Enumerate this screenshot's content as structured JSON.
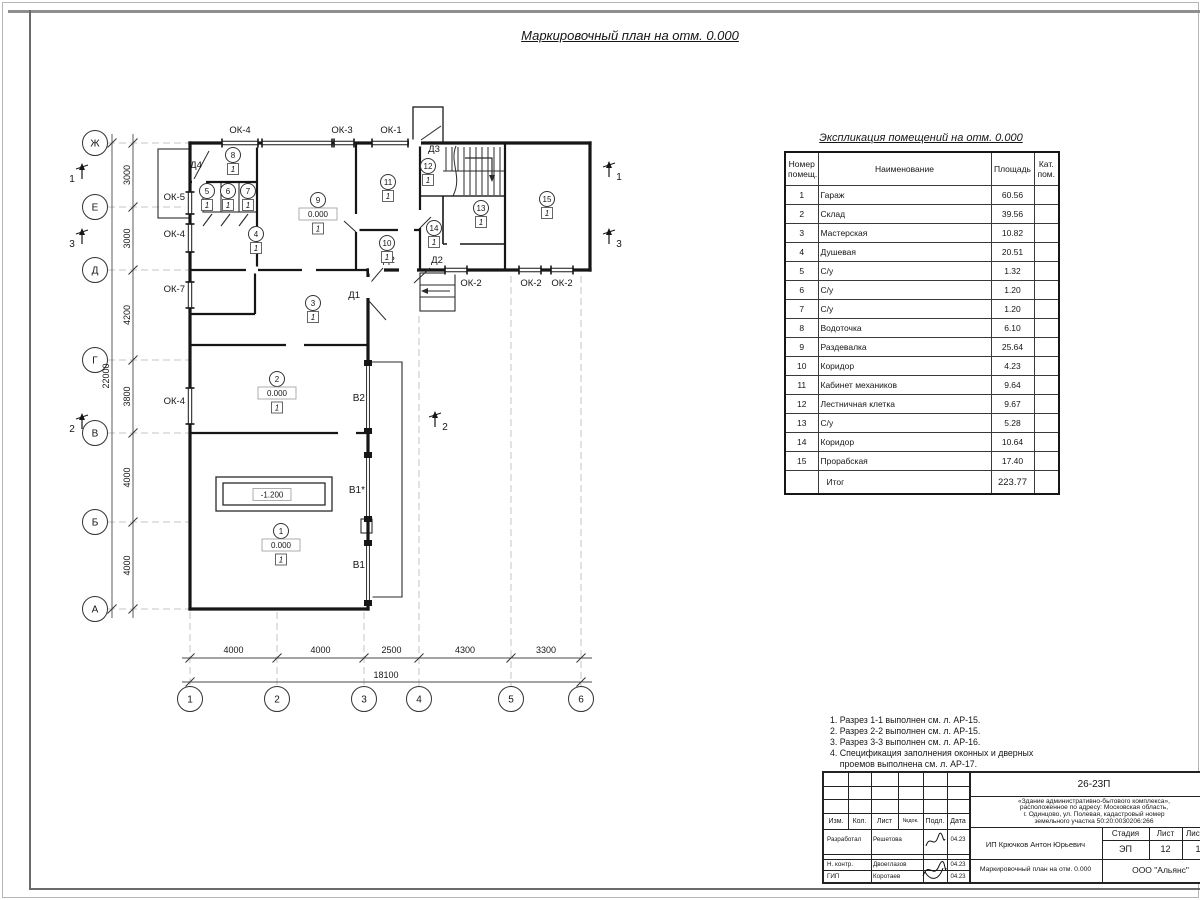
{
  "page": {
    "title": "Маркировочный план на отм. 0.000"
  },
  "table": {
    "title": "Экспликация помещений на отм. 0.000",
    "headers": {
      "num": "Номер помещ.",
      "name": "Наименование",
      "area": "Площадь",
      "cat": "Кат. пом."
    },
    "rows": [
      {
        "num": "1",
        "name": "Гараж",
        "area": "60.56"
      },
      {
        "num": "2",
        "name": "Склад",
        "area": "39.56"
      },
      {
        "num": "3",
        "name": "Мастерская",
        "area": "10.82"
      },
      {
        "num": "4",
        "name": "Душевая",
        "area": "20.51"
      },
      {
        "num": "5",
        "name": "С/у",
        "area": "1.32"
      },
      {
        "num": "6",
        "name": "С/у",
        "area": "1.20"
      },
      {
        "num": "7",
        "name": "С/у",
        "area": "1.20"
      },
      {
        "num": "8",
        "name": "Водоточка",
        "area": "6.10"
      },
      {
        "num": "9",
        "name": "Раздевалка",
        "area": "25.64"
      },
      {
        "num": "10",
        "name": "Коридор",
        "area": "4.23"
      },
      {
        "num": "11",
        "name": "Кабинет механиков",
        "area": "9.64"
      },
      {
        "num": "12",
        "name": "Лестничная клетка",
        "area": "9.67"
      },
      {
        "num": "13",
        "name": "С/у",
        "area": "5.28"
      },
      {
        "num": "14",
        "name": "Коридор",
        "area": "10.64"
      },
      {
        "num": "15",
        "name": "Прорабская",
        "area": "17.40"
      }
    ],
    "total": {
      "label": "Итог",
      "area": "223.77"
    }
  },
  "notes": [
    "1. Разрез 1-1 выполнен см. л. АР-15.",
    "2. Разрез 2-2 выполнен см. л. АР-15.",
    "3. Разрез 3-3 выполнен см. л. АР-16.",
    "4. Спецификация заполнения оконных и дверных",
    "    проемов выполнена см. л. АР-17.",
    "5. Экспликация полов выполнена см. л. АР-17."
  ],
  "stamp": {
    "doc_number": "26-23П",
    "object_lines": [
      "«Здание административно-бытового комплекса»,",
      "расположенное по адресу: Московская область,",
      "г. Одинцово, ул. Полевая, кадастровый номер",
      "земельного участка 50:20:0030206:266"
    ],
    "rev_headers": [
      "Изм.",
      "Кол.",
      "Лист",
      "№док.",
      "Подл.",
      "Дата"
    ],
    "roles": [
      {
        "role": "Разработал",
        "name": "Решетова",
        "date": "04.23"
      },
      {
        "role": "Н. контр.",
        "name": "Двоеглазов",
        "date": "04.23"
      },
      {
        "role": "ГИП",
        "name": "Коротаев",
        "date": "04.23"
      }
    ],
    "client": "ИП Крючков Антон Юрьевич",
    "stage_label": "Стадия",
    "sheet_label": "Лист",
    "sheets_label": "Листов",
    "stage": "ЭП",
    "sheet": "12",
    "sheets": "17",
    "sheet_title": "Маркировочный план на отм. 0.000",
    "company": "ООО \"Альянс\""
  },
  "plan": {
    "axis_rows": [
      {
        "l": "Ж",
        "y": 143
      },
      {
        "l": "Е",
        "y": 207
      },
      {
        "l": "Д",
        "y": 270
      },
      {
        "l": "Г",
        "y": 360
      },
      {
        "l": "В",
        "y": 433
      },
      {
        "l": "Б",
        "y": 522
      },
      {
        "l": "А",
        "y": 609
      }
    ],
    "axis_cols": [
      {
        "l": "1",
        "x": 190
      },
      {
        "l": "2",
        "x": 277
      },
      {
        "l": "3",
        "x": 364
      },
      {
        "l": "4",
        "x": 419
      },
      {
        "l": "5",
        "x": 511
      },
      {
        "l": "6",
        "x": 581
      }
    ],
    "dims_left": {
      "segments": [
        "3000",
        "3000",
        "4200",
        "3800",
        "4000",
        "4000"
      ],
      "total": "22000"
    },
    "dims_bottom": {
      "segments": [
        "4000",
        "4000",
        "2500",
        "4300",
        "3300"
      ],
      "total": "18100"
    },
    "rooms": [
      {
        "n": "1",
        "x": 281,
        "y": 531,
        "level": "0.000",
        "floor": "1"
      },
      {
        "n": "2",
        "x": 277,
        "y": 379,
        "level": "0.000",
        "floor": "1"
      },
      {
        "n": "3",
        "x": 313,
        "y": 303,
        "floor": "1"
      },
      {
        "n": "4",
        "x": 256,
        "y": 234,
        "floor": "1"
      },
      {
        "n": "5",
        "x": 207,
        "y": 191,
        "floor": "1"
      },
      {
        "n": "6",
        "x": 228,
        "y": 191,
        "floor": "1"
      },
      {
        "n": "7",
        "x": 248,
        "y": 191,
        "floor": "1"
      },
      {
        "n": "8",
        "x": 233,
        "y": 155,
        "floor": "1"
      },
      {
        "n": "9",
        "x": 318,
        "y": 200,
        "level": "0.000",
        "floor": "1"
      },
      {
        "n": "10",
        "x": 387,
        "y": 243,
        "floor": "1"
      },
      {
        "n": "11",
        "x": 388,
        "y": 182,
        "floor": "1"
      },
      {
        "n": "12",
        "x": 428,
        "y": 166,
        "floor": "1"
      },
      {
        "n": "13",
        "x": 481,
        "y": 208,
        "floor": "1"
      },
      {
        "n": "14",
        "x": 434,
        "y": 228,
        "floor": "1"
      },
      {
        "n": "15",
        "x": 547,
        "y": 199,
        "floor": "1"
      }
    ],
    "windows": [
      {
        "label": "ОК-4",
        "lx": 240,
        "ly": 133,
        "a": "middle",
        "x1": 222,
        "y1": 143,
        "x2": 258,
        "y2": 143
      },
      {
        "label": "",
        "lx": 0,
        "ly": 0,
        "a": "middle",
        "x1": 262,
        "y1": 143,
        "x2": 332,
        "y2": 143
      },
      {
        "label": "ОК-3",
        "lx": 342,
        "ly": 133,
        "a": "middle",
        "x1": 334,
        "y1": 143,
        "x2": 354,
        "y2": 143
      },
      {
        "label": "ОК-1",
        "lx": 391,
        "ly": 133,
        "a": "middle",
        "x1": 372,
        "y1": 143,
        "x2": 408,
        "y2": 143
      },
      {
        "label": "ОК-5",
        "lx": 185,
        "ly": 200,
        "a": "end",
        "x1": 190,
        "y1": 192,
        "x2": 190,
        "y2": 214
      },
      {
        "label": "ОК-4",
        "lx": 185,
        "ly": 237,
        "a": "end",
        "x1": 190,
        "y1": 224,
        "x2": 190,
        "y2": 252
      },
      {
        "label": "ОК-7",
        "lx": 185,
        "ly": 292,
        "a": "end",
        "x1": 190,
        "y1": 282,
        "x2": 190,
        "y2": 308
      },
      {
        "label": "ОК-4",
        "lx": 185,
        "ly": 404,
        "a": "end",
        "x1": 190,
        "y1": 388,
        "x2": 190,
        "y2": 424
      },
      {
        "label": "ОК-2",
        "lx": 471,
        "ly": 286,
        "a": "middle",
        "x1": 445,
        "y1": 270,
        "x2": 467,
        "y2": 270
      },
      {
        "label": "ОК-2",
        "lx": 531,
        "ly": 286,
        "a": "middle",
        "x1": 519,
        "y1": 270,
        "x2": 541,
        "y2": 270
      },
      {
        "label": "ОК-2",
        "lx": 562,
        "ly": 286,
        "a": "middle",
        "x1": 551,
        "y1": 270,
        "x2": 573,
        "y2": 270
      }
    ],
    "doors": [
      {
        "label": "Д4",
        "lx": 196,
        "ly": 168,
        "a": "middle",
        "gap": [
          192,
          182,
          206,
          182
        ],
        "leaf": [
          194,
          179,
          209,
          151
        ]
      },
      {
        "label": "Д3",
        "lx": 434,
        "ly": 152,
        "a": "middle",
        "gap": [
          409,
          143,
          421,
          143
        ],
        "leaf": [
          421,
          140,
          441,
          126
        ]
      },
      {
        "label": "Д2",
        "lx": 389,
        "ly": 263,
        "a": "middle",
        "gap": [
          369,
          270,
          384,
          270
        ],
        "leaf": [
          383,
          268,
          371,
          282
        ]
      },
      {
        "label": "Д2",
        "lx": 437,
        "ly": 263,
        "a": "middle",
        "gap": [
          399,
          270,
          417,
          270
        ],
        "leaf": [
          430,
          268,
          414,
          283
        ]
      },
      {
        "label": "Д1",
        "lx": 360,
        "ly": 298,
        "a": "end",
        "gap": [
          368,
          277,
          368,
          298
        ],
        "leaf": [
          369,
          301,
          386,
          320
        ]
      }
    ],
    "gates": [
      {
        "label": "В2",
        "lx": 365,
        "ly": 401,
        "y1": 366,
        "y2": 428
      },
      {
        "label": "В1*",
        "lx": 365,
        "ly": 493,
        "y1": 458,
        "y2": 516
      },
      {
        "label": "В1",
        "lx": 365,
        "ly": 568,
        "y1": 546,
        "y2": 600
      }
    ],
    "levels": [
      {
        "t": "-1.200",
        "x": 272,
        "y": 495
      }
    ],
    "sections": [
      {
        "n": "1",
        "x": 72,
        "y": 182,
        "side": "l"
      },
      {
        "n": "3",
        "x": 72,
        "y": 247,
        "side": "l"
      },
      {
        "n": "2",
        "x": 72,
        "y": 432,
        "side": "l"
      },
      {
        "n": "1",
        "x": 619,
        "y": 180,
        "side": "r"
      },
      {
        "n": "3",
        "x": 619,
        "y": 247,
        "side": "r"
      },
      {
        "n": "2",
        "x": 445,
        "y": 430,
        "side": "r"
      }
    ]
  }
}
